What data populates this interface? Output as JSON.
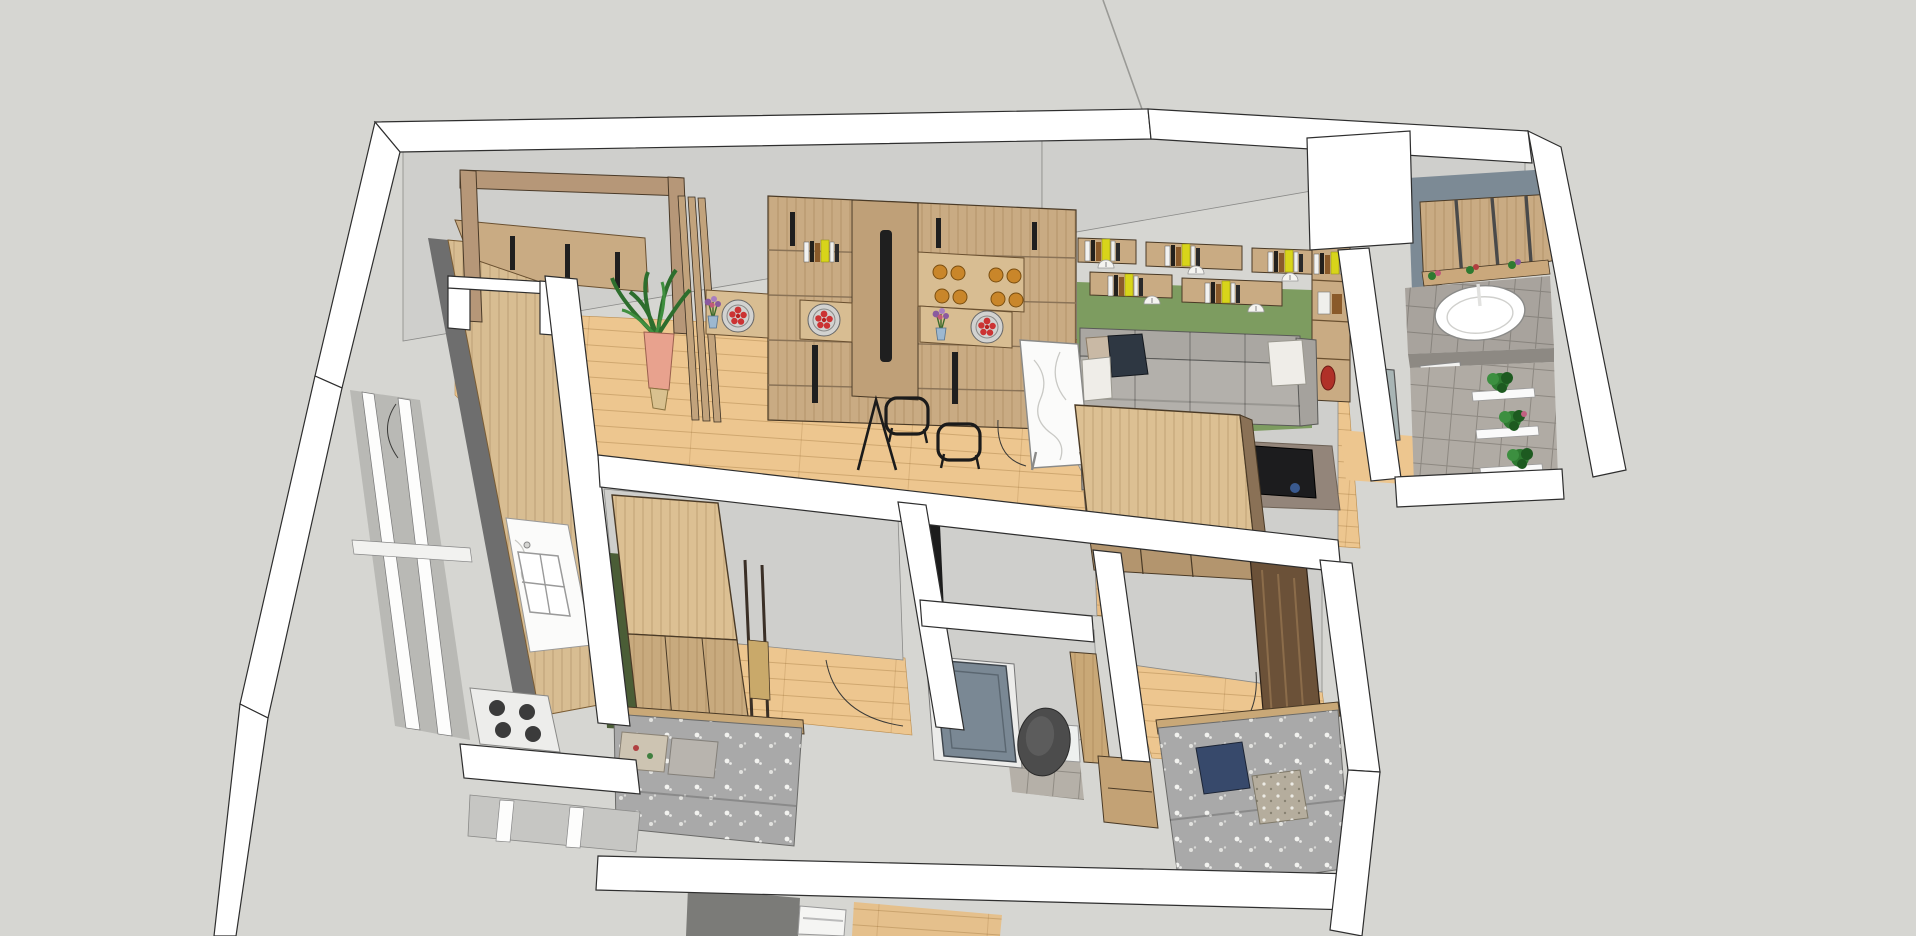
{
  "scene": {
    "type": "3d-architectural-model",
    "view": "overhead cutaway dollhouse perspective of an apartment",
    "style": "SketchUp-like white-outline render, no UI chrome visible"
  },
  "viewport": {
    "width": 1916,
    "height": 936
  },
  "colors": {
    "background": "#d6d6d2",
    "guide_line": "#9a9a96",
    "wall_white": "#ffffff",
    "wall_gray": "#cfcfcc",
    "wall_gray_dark": "#c2c2bf",
    "wall_dark_edge": "#6e6e6e",
    "wood_floor": "#edc68f",
    "plank_line": "#d8a96a",
    "cabinet_wood": "#c9ab83",
    "cabinet_wood_light": "#d8bd92",
    "cabinet_slot": "#1f1f1f",
    "door_frame_wood": "#b69778",
    "slat_wood": "#c2a37c",
    "green_wall": "#7d9c60",
    "green_wall_dark": "#4a5d36",
    "sofa": "#aaa7a2",
    "sofa_seat": "#b3b0ab",
    "pillow_navy": "#2e3742",
    "pillow_white": "#efede8",
    "pillow_beige": "#c9b9a5",
    "pillow_blue": "#37496b",
    "rug": "#93857a",
    "marble": "#fbfbfa",
    "table_dark": "#1c1c1e",
    "bath_wall": "#7c8a95",
    "bath_tile": "#a8a39d",
    "tile_floor": "#b0aba4",
    "bed_fabric": "#a9a9a9",
    "bed_wood": "#c9a877",
    "wardrobe_top": "#dcc093",
    "wardrobe_front": "#c8aa7e",
    "wardrobe_side": "#8a7156",
    "dark_closet": "#6b5138",
    "toilet": "#4c4c4c",
    "door_slate": "#7a8894",
    "plant_green": "#2e7a31",
    "plant_green_dark": "#1d5a20",
    "pot_pink": "#e8a28e",
    "basket": "#d9c18f",
    "book_yellow": "#d8d41a",
    "plate_red": "#cc3333",
    "cup_amber": "#c9862a",
    "vase_red": "#b03028",
    "flower_purple": "#8a5a9f",
    "stove_white": "#ededeb",
    "window_gray": "#b9b9b5"
  },
  "rooms": [
    {
      "id": "entry-hall",
      "items": [
        "wood-door-frame",
        "potted-plant",
        "slat-room-divider",
        "inner-doorway-wall"
      ]
    },
    {
      "id": "kitchen",
      "items": [
        "l-shaped-wood-counter",
        "upper-cabinets",
        "double-sink",
        "gas-stove",
        "window-wall",
        "door-swing-arc"
      ]
    },
    {
      "id": "living-room",
      "items": [
        "storage-cabinet-wall",
        "floating-bookshelves",
        "green-accent-wall",
        "sectional-sofa",
        "throw-pillows",
        "area-rug",
        "coffee-table",
        "dark-side-table",
        "marble-dining-table",
        "wireframe-chairs",
        "column-bookshelf",
        "door-swing-arc"
      ]
    },
    {
      "id": "bedroom-1",
      "items": [
        "wardrobe",
        "bed-with-floral-bedding",
        "desk-frame",
        "green-accent-wall",
        "door-swing-arc"
      ]
    },
    {
      "id": "hallway",
      "items": [
        "raised-wood-platform"
      ]
    },
    {
      "id": "bathroom",
      "items": [
        "slate-door",
        "dark-toilet",
        "white-cistern",
        "wood-partition"
      ]
    },
    {
      "id": "bedroom-2",
      "items": [
        "large-wardrobe",
        "dark-wood-closet",
        "bed-with-blue-pillow",
        "bedside-cabinet",
        "door-swing-arc"
      ]
    },
    {
      "id": "utility-bath",
      "items": [
        "slat-wall-panel",
        "tiled-vanity",
        "oval-sink",
        "washing-machine",
        "tiled-floor",
        "plant-shelf"
      ]
    }
  ],
  "decor": {
    "red_plates": 3,
    "purple_flower_vases": 2,
    "amber_cups": 8,
    "dome_lamps": 5,
    "yellow_books": "multiple spines across shelves",
    "red_vase": 1,
    "green_plants": 4
  }
}
